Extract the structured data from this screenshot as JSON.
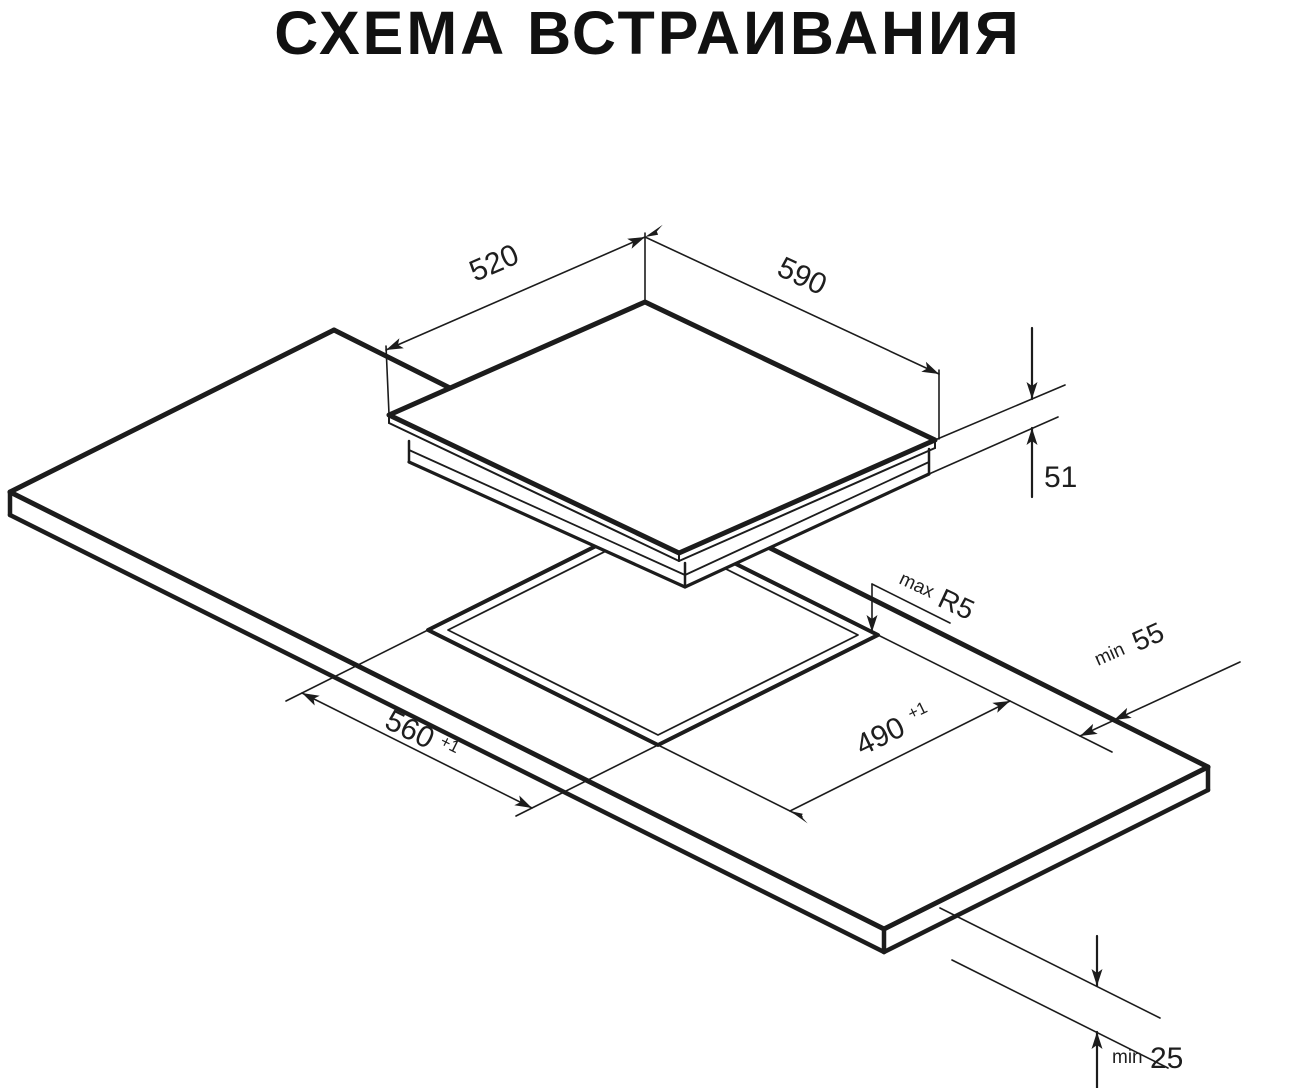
{
  "title": "СХЕМА ВСТРАИВАНИЯ",
  "diagram": {
    "description": "isometric built-in installation drawing of a hob above a worktop cutout",
    "colors": {
      "line": "#1c1c1c",
      "text": "#1e1e1e",
      "background": "#ffffff"
    },
    "dimensions": {
      "hob_depth_label": "520",
      "hob_width_label": "590",
      "hob_height_label": "51",
      "corner_radius": {
        "prefix": "max",
        "value": "R5"
      },
      "rear_clearance": {
        "prefix": "min",
        "value": "55"
      },
      "cutout_width": {
        "value": "560",
        "tolerance": "+1"
      },
      "cutout_depth": {
        "value": "490",
        "tolerance": "+1"
      },
      "bottom_clearance": {
        "prefix": "min",
        "value": "25"
      }
    }
  }
}
